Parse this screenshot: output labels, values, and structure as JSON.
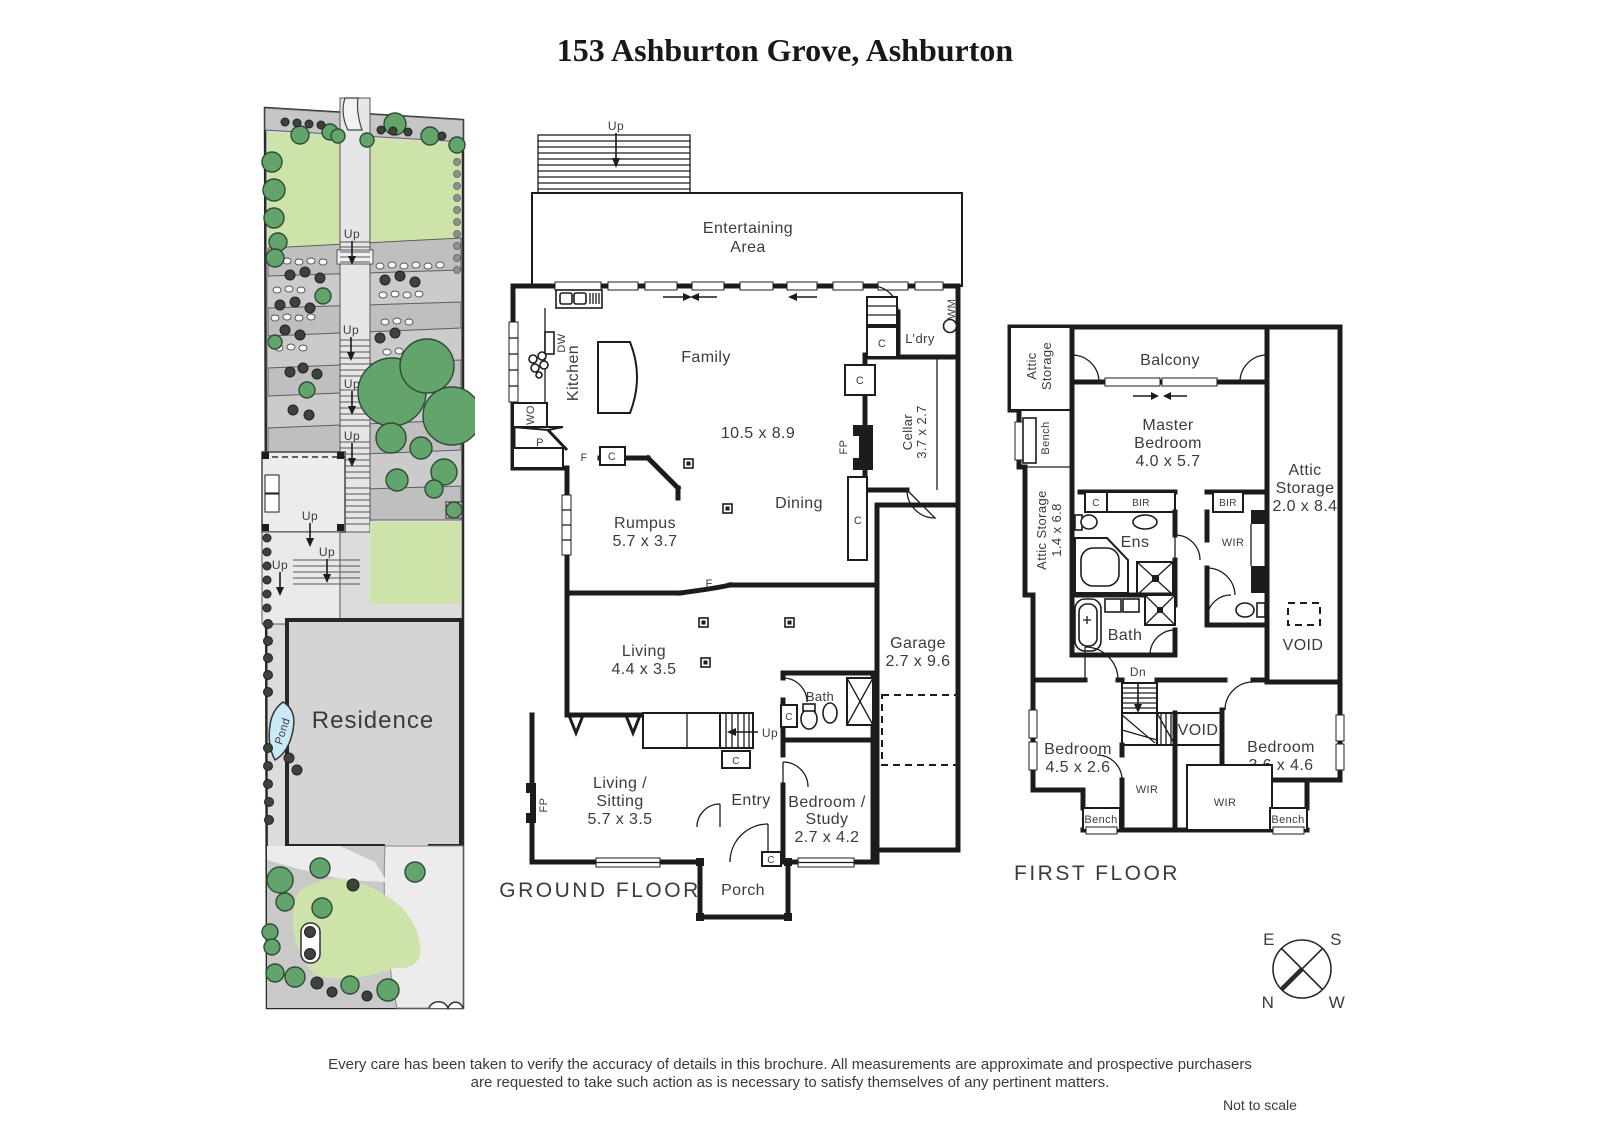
{
  "title": "153 Ashburton Grove, Ashburton",
  "site": {
    "residence": "Residence",
    "pond": "Pond",
    "up": [
      "Up",
      "Up",
      "Up",
      "Up",
      "Up",
      "Up",
      "Up"
    ]
  },
  "ground": {
    "floor_title": "GROUND FLOOR",
    "up_deck": "Up",
    "up_stairs": "Up",
    "entertaining": [
      "Entertaining",
      "Area"
    ],
    "family": {
      "name": "Family",
      "dims": "10.5 x 8.9"
    },
    "kitchen": "Kitchen",
    "dw": "DW",
    "wo": "WO",
    "p": "P",
    "f": [
      "F",
      "F"
    ],
    "c": [
      "C",
      "C",
      "C",
      "C",
      "C",
      "C",
      "C"
    ],
    "ldry": "L’dry",
    "wm": "WM",
    "cellar": {
      "name": "Cellar",
      "dims": "3.7 x 2.7"
    },
    "fp": [
      "FP",
      "FP"
    ],
    "dining": "Dining",
    "rumpus": {
      "name": "Rumpus",
      "dims": "5.7 x 3.7"
    },
    "living": {
      "name": "Living",
      "dims": "4.4 x 3.5"
    },
    "garage": {
      "name": "Garage",
      "dims": "2.7 x 9.6"
    },
    "bath": "Bath",
    "living_sitting": {
      "l1": "Living /",
      "l2": "Sitting",
      "dims": "5.7 x 3.5"
    },
    "entry": "Entry",
    "bed_study": {
      "l1": "Bedroom /",
      "l2": "Study",
      "dims": "2.7 x 4.2"
    },
    "porch": "Porch"
  },
  "first": {
    "floor_title": "FIRST FLOOR",
    "attic_tl": [
      "Attic",
      "Storage"
    ],
    "balcony": "Balcony",
    "master": {
      "l1": "Master",
      "l2": "Bedroom",
      "dims": "4.0 x 5.7"
    },
    "attic_right": {
      "l1": "Attic",
      "l2": "Storage",
      "dims": "2.0 x 8.4"
    },
    "bench_left": "Bench",
    "attic_left": {
      "l1": "Attic Storage",
      "dims": "1.4 x 6.8"
    },
    "c": "C",
    "bir": [
      "BIR",
      "BIR"
    ],
    "ens": "Ens",
    "wir": [
      "WIR",
      "WIR",
      "WIR"
    ],
    "bath": "Bath",
    "void": [
      "VOID",
      "VOID"
    ],
    "dn": "Dn",
    "bed1": {
      "name": "Bedroom",
      "dims": "4.5 x 2.6"
    },
    "bed2": {
      "name": "Bedroom",
      "dims": "3.6 x 4.6"
    },
    "bench": [
      "Bench",
      "Bench"
    ]
  },
  "compass": {
    "e": "E",
    "s": "S",
    "n": "N",
    "w": "W"
  },
  "footer": {
    "line1": "Every care has been taken to verify the accuracy of details in this brochure.  All measurements are approximate and prospective purchasers",
    "line2": "are requested to take such action as is necessary to satisfy themselves of any pertinent matters.",
    "scale": "Not to scale"
  }
}
